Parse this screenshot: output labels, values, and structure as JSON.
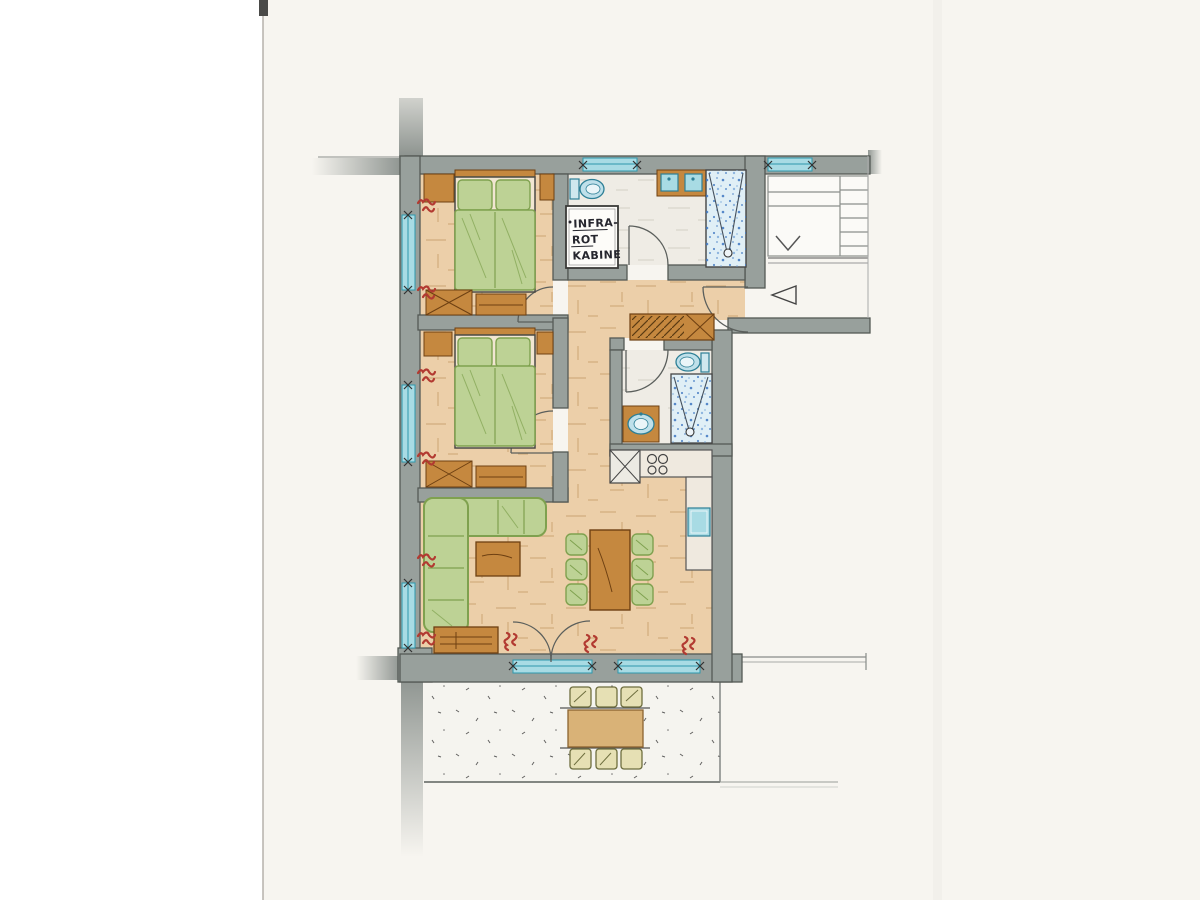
{
  "labels": {
    "infrared_cabin": {
      "line1": "INFRA-",
      "line2": "ROT",
      "line3": "KABINE"
    }
  },
  "symbols": {
    "entry_arrow": "left-pointing triangle at apartment entrance",
    "stair_direction_arrow": "down chevron on stair flight",
    "window_tick": "x tick at window jambs",
    "dimension_scribbles": "illegible red handwritten dimension marks"
  },
  "palette": {
    "paper": "#f7f5f0",
    "margin": "#ffffff",
    "wall": "#98a09c",
    "walledge": "#545955",
    "floor": "#eccfa9",
    "floorstroke": "#b98e57",
    "wood": "#c5883f",
    "woodedge": "#6e4012",
    "green": "#bdd295",
    "greenedge": "#7fa14f",
    "glass": "#a8dbe4",
    "glassline": "#2e97ad",
    "showerbg": "#e0eff6",
    "showerdot": "#3d76c1",
    "bath": "#efece5",
    "tileline": "#b7b2a6",
    "terrace": "#f5f4ef",
    "terracedot": "#3b3b3b",
    "red": "#b23a31",
    "ink": "#26262e",
    "pencil": "#8b8f8c",
    "outline": "#3f4442"
  }
}
